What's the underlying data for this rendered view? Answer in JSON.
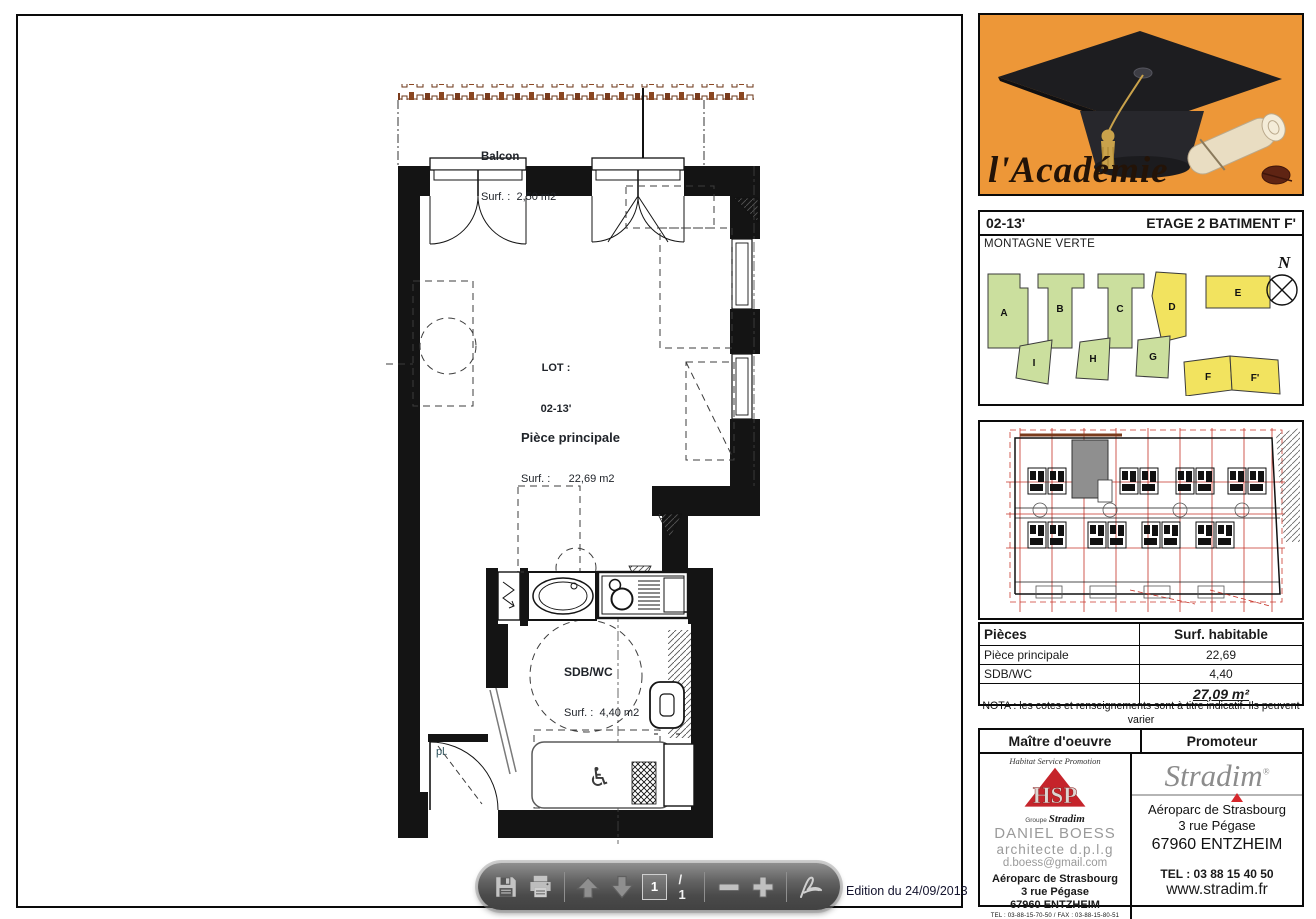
{
  "viewer": {
    "edition": "Edition du 24/09/2013",
    "toolbar": {
      "page_current": "1",
      "page_total": "/ 1"
    }
  },
  "plan": {
    "balcony_label": "Balcon",
    "balcony_surface": "Surf. :  2,50 m2",
    "lot_label": "LOT :",
    "lot_value": "02-13'",
    "main_room_label": "Pièce principale",
    "main_room_surface": "Surf. :      22,69 m2",
    "bathroom_label": "SDB/WC",
    "bathroom_surface": "Surf. :  4,40 m2",
    "closet_label": "pl."
  },
  "sidebar": {
    "logo": {
      "brand": "l'Académie"
    },
    "site": {
      "lot": "02-13'",
      "floor": "ETAGE 2 BATIMENT F'",
      "district": "MONTAGNE VERTE",
      "compass": "N",
      "buildings": [
        "A",
        "B",
        "C",
        "D",
        "E",
        "I",
        "H",
        "G",
        "F",
        "F'"
      ]
    },
    "surface_table": {
      "headers": [
        "Pièces",
        "Surf. habitable"
      ],
      "rows": [
        {
          "label": "Pièce principale",
          "value": "22,69"
        },
        {
          "label": "SDB/WC",
          "value": "4,40"
        }
      ],
      "total": "27,09 m²"
    },
    "nota_line1": "NOTA : les cotes et renseignements sont à titre indicatif. Ils peuvent varier",
    "nota_line2": "en fonction des besoins techniques lors de la réalisation du bâtiment.",
    "contacts": {
      "left_header": "Maître d'oeuvre",
      "right_header": "Promoteur",
      "architect": {
        "tagline": "Habitat Service Promotion",
        "logo_text": "HSP",
        "group_small": "Groupe",
        "group_name": "Stradim",
        "name": "DANIEL BOESS",
        "title": "architecte d.p.l.g",
        "email": "d.boess@gmail.com",
        "address1": "Aéroparc de Strasbourg",
        "address2": "3 rue Pégase",
        "address3": "67960 ENTZHEIM",
        "phone_fax": "TEL : 03-88-15-70-50 / FAX : 03-88-15-80-51"
      },
      "promoter": {
        "logo_text": "Stradim",
        "registered": "®",
        "address1": "Aéroparc de Strasbourg",
        "address2": "3 rue Pégase",
        "address3": "67960 ENTZHEIM",
        "phone": "TEL : 03 88 15 40 50",
        "website": "www.stradim.fr"
      }
    }
  }
}
